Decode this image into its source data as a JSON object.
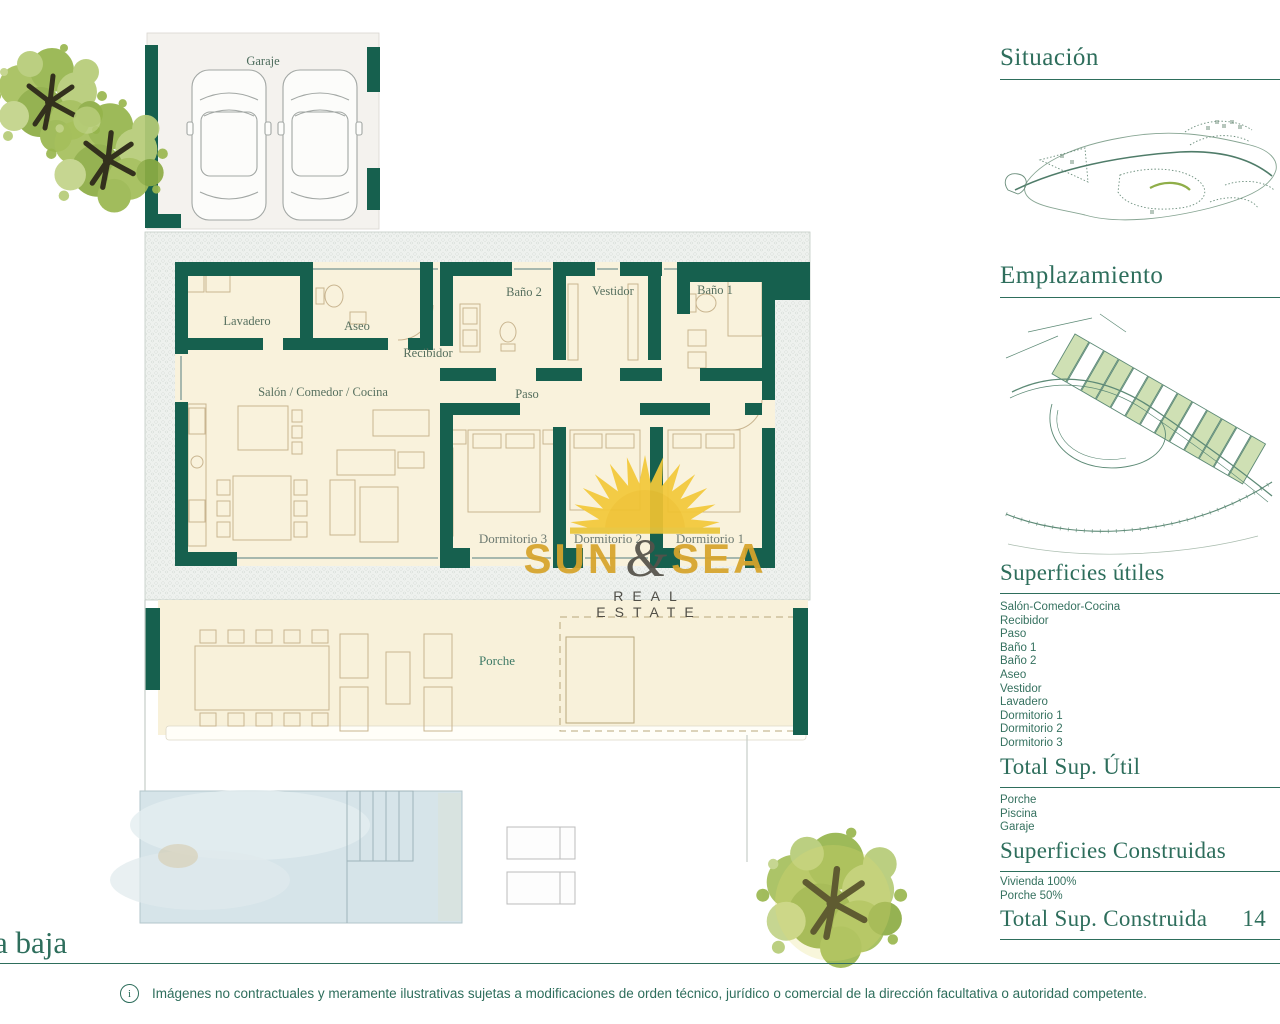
{
  "plan": {
    "floor_label": "a baja",
    "rooms": {
      "garaje": "Garaje",
      "lavadero": "Lavadero",
      "aseo": "Aseo",
      "recibidor": "Recibidor",
      "bano2": "Baño 2",
      "vestidor": "Vestidor",
      "bano1": "Baño 1",
      "salon": "Salón / Comedor / Cocina",
      "paso": "Paso",
      "dormitorio3": "Dormitorio 3",
      "dormitorio2": "Dormitorio 2",
      "dormitorio1": "Dormitorio 1",
      "porche": "Porche"
    }
  },
  "logo": {
    "word1": "SUN",
    "ampersand": "&",
    "word2": "SEA",
    "tagline": "REAL ESTATE"
  },
  "sidebar": {
    "situacion": {
      "title": "Situación"
    },
    "emplazamiento": {
      "title": "Emplazamiento"
    },
    "superficies_utiles": {
      "title": "Superficies útiles",
      "items": [
        "Salón-Comedor-Cocina",
        "Recibidor",
        "Paso",
        "Baño 1",
        "Baño 2",
        "Aseo",
        "Vestidor",
        "Lavadero",
        "Dormitorio 1",
        "Dormitorio 2",
        "Dormitorio 3"
      ]
    },
    "total_util": {
      "title": "Total Sup. Útil"
    },
    "exterior_items": [
      "Porche",
      "Piscina",
      "Garaje"
    ],
    "superficies_construidas": {
      "title": "Superficies Construidas",
      "items": [
        "Vivienda 100%",
        "Porche 50%"
      ]
    },
    "total_construida": {
      "title": "Total Sup. Construida",
      "value": "14"
    }
  },
  "footer": {
    "info_symbol": "i",
    "disclaimer": "Imágenes no contractuales y meramente ilustrativas sujetas a modificaciones de orden técnico, jurídico o comercial de la dirección facultativa o autoridad competente."
  },
  "colors": {
    "wall_teal": "#16604e",
    "heading_green": "#2e6e5c",
    "cream": "#f9f2dc",
    "plot_green": "#cfe0b4",
    "sun_yellow": "#f3c93a",
    "logo_gold": "#d7a42b",
    "pool_blue": "#d6e4e9"
  }
}
